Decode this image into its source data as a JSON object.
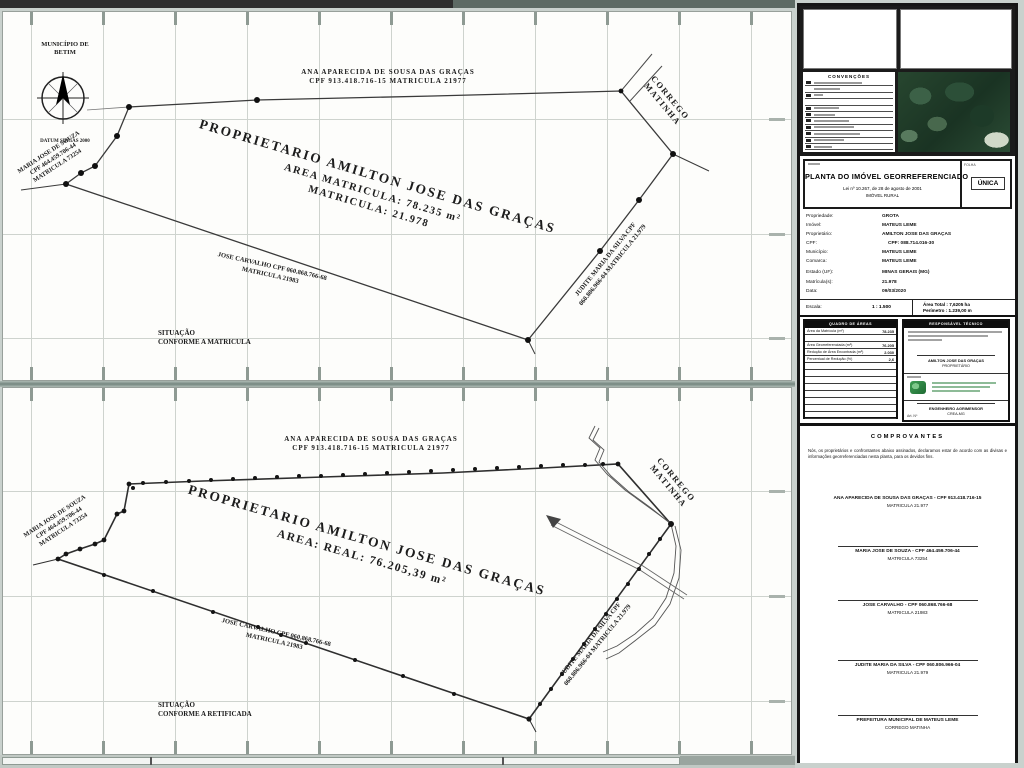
{
  "map_top": {
    "municipality_line1": "MUNICÍPIO DE",
    "municipality_line2": "BETIM",
    "datum": "DATUM SIRGAS 2000",
    "neighbor_top_line1": "ANA APARECIDA DE SOUSA DAS GRAÇAS",
    "neighbor_top_line2": "CPF 913.418.716-15 MATRICULA 21977",
    "stream_line1": "CORREGO",
    "stream_line2": "MATINHA",
    "neighbor_left_line1": "MARIA JOSE DE SOUZA",
    "neighbor_left_line2": "CPF 464.459.706-44",
    "neighbor_left_line3": "MATRICULA 73254",
    "owner_line1": "PROPRIETARIO AMILTON JOSE DAS GRAÇAS",
    "owner_line2": "AREA MATRICULA: 78.235 m²",
    "owner_line3": "MATRICULA: 21.978",
    "neighbor_bottom_line1": "JOSE CARVALHO CPF 060.868.766-68",
    "neighbor_bottom_line2": "MATRICULA 21983",
    "neighbor_right_line1": "JUDITE MARIA DA SILVA CPF",
    "neighbor_right_line2": "060.806.966-04 MATRICULA 21.979",
    "situation_line1": "SITUAÇÃO",
    "situation_line2": "CONFORME A MATRICULA"
  },
  "map_bottom": {
    "neighbor_top_line1": "ANA APARECIDA DE SOUSA DAS GRAÇAS",
    "neighbor_top_line2": "CPF 913.418.716-15 MATRICULA 21977",
    "stream_line1": "CORREGO",
    "stream_line2": "MATINHA",
    "neighbor_left_line1": "MARIA JOSE DE SOUZA",
    "neighbor_left_line2": "CPF 464.459.706-44",
    "neighbor_left_line3": "MATRICULA 73254",
    "owner_line1": "PROPRIETARIO AMILTON JOSE DAS GRAÇAS",
    "owner_line2": "AREA: REAL: 76.205,39 m²",
    "neighbor_bottom_line1": "JOSE CARVALHO CPF 060.868.766-68",
    "neighbor_bottom_line2": "MATRICULA 21983",
    "neighbor_right_line1": "JUDITE MARIA DA SILVA CPF",
    "neighbor_right_line2": "060.806.966-04 MATRICULA 21.979",
    "situation_line1": "SITUAÇÃO",
    "situation_line2": "CONFORME A RETIFICADA"
  },
  "titleblock": {
    "legend_title": "CONVENÇÕES",
    "title": "PLANTA DO IMÓVEL GEORREFERENCIADO",
    "subtitle1": "Lei nº 10.267, de 28 de agosto de 2001",
    "subtitle2": "IMÓVEL RURAL",
    "sheet_label": "FOLHA",
    "sheet_value": "ÚNICA",
    "fields": [
      {
        "label": "Propriedade:",
        "value": "GROTA"
      },
      {
        "label": "Imóvel:",
        "value": "MATEUS LEME"
      },
      {
        "label": "Proprietário:",
        "value": "AMILTON JOSE DAS GRAÇAS"
      },
      {
        "label": "CPF:",
        "value": "CPF: 088.714.016-30"
      },
      {
        "label": "Município:",
        "value": "MATEUS LEME"
      },
      {
        "label": "Comarca:",
        "value": "MATEUS LEME"
      },
      {
        "label": "Estado (UF):",
        "value": "MINAS GERAIS (MG)"
      },
      {
        "label": "Matrícula(s):",
        "value": "21.978"
      },
      {
        "label": "Data:",
        "value": "09/03/2020"
      }
    ],
    "scale_label": "Escala:",
    "scale_value": "1 : 1.500",
    "area_total": "Área Total : 7,6205 ha",
    "perimeter": "Perímetro : 1.239,00 m",
    "areas_table": {
      "header": "QUADRO DE ÁREAS",
      "rows": [
        {
          "label": "Área da Matrícula (m²)",
          "value": "78.235"
        },
        {
          "label": "Área Georreferenciada (m²)",
          "value": "76.205"
        },
        {
          "label": "Redução de Área Encontrada (m²)",
          "value": "2.030"
        },
        {
          "label": "Percentual de Redução (%)",
          "value": "2,6"
        }
      ]
    },
    "tech_box": {
      "header": "RESPONSÁVEL TÉCNICO",
      "sig1_line1": "AMILTON JOSE DAS GRAÇAS",
      "sig1_line2": "PROPRIETÁRIO",
      "sig2_line1": "ENGENHEIRO AGRIMENSOR",
      "sig2_line2": "CREA-MG",
      "art_label": "Art. Nº"
    }
  },
  "comprovantes": {
    "title": "COMPROVANTES",
    "paragraph": "Nós, os proprietários e confrontantes abaixo assinados, declaramos estar de acordo com as divisas e informações georreferenciadas nesta planta, para os devidos fins.",
    "signatures": [
      {
        "name": "ANA APARECIDA DE SOUSA DAS GRAÇAS - CPF 913.418.716-15",
        "detail": "MATRICULA 21.977"
      },
      {
        "name": "MARIA JOSE DE SOUZA - CPF 464.459.706-44",
        "detail": "MATRICULA 73254"
      },
      {
        "name": "JOSE CARVALHO - CPF 060.868.766-68",
        "detail": "MATRICULA 21983"
      },
      {
        "name": "JUDITE MARIA DA SILVA - CPF 060.806.966-04",
        "detail": "MATRICULA 21.979"
      },
      {
        "name": "PREFEITURA MUNICIPAL DE MATEUS LEME",
        "detail": "CORREGO MATINHA"
      }
    ]
  },
  "colors": {
    "divider_band": "#74867f",
    "top_bar_dark": "#2e2e2e",
    "photo_green": "#20402c"
  }
}
